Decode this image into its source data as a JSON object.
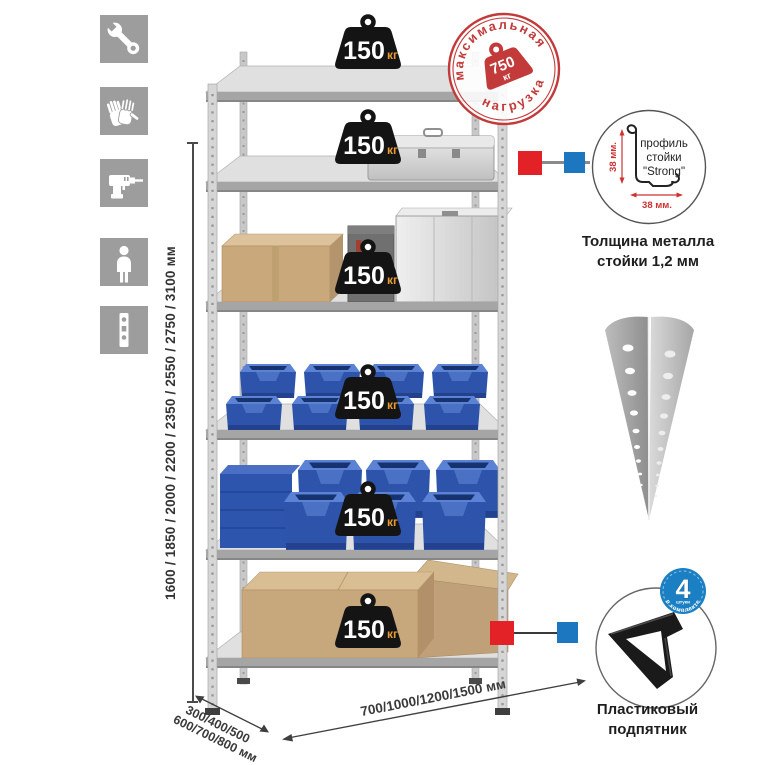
{
  "sidebar": {
    "icons": [
      {
        "name": "wrench-icon"
      },
      {
        "name": "gloves-icon"
      },
      {
        "name": "drill-icon"
      },
      {
        "name": "person-icon"
      },
      {
        "name": "post-icon"
      }
    ]
  },
  "height_dimension": {
    "label": "1600 / 1850 / 2000 / 2200 / 2350 / 2550 / 2750 / 3100 мм"
  },
  "depth_dimension": {
    "line1": "300/400/500",
    "line2": "600/700/800 мм"
  },
  "width_dimension": {
    "label": "700/1000/1200/1500 мм"
  },
  "shelves": [
    {
      "weight": "150",
      "unit": "кг"
    },
    {
      "weight": "150",
      "unit": "кг"
    },
    {
      "weight": "150",
      "unit": "кг"
    },
    {
      "weight": "150",
      "unit": "кг"
    },
    {
      "weight": "150",
      "unit": "кг"
    },
    {
      "weight": "150",
      "unit": "кг"
    }
  ],
  "max_load_stamp": {
    "arc_top": "максимальная",
    "arc_bottom": "нагрузка",
    "value": "750",
    "unit": "кг"
  },
  "profile_detail": {
    "line1": "профиль",
    "line2": "стойки",
    "line3": "\"Strong\"",
    "dim_v": "38 мм.",
    "dim_h": "38 мм.",
    "caption1": "Толщина металла",
    "caption2": "стойки 1,2 мм"
  },
  "foot_detail": {
    "badge_value": "4",
    "badge_sub": "штуки",
    "badge_arc": "в комплекте",
    "caption1": "Пластиковый",
    "caption2": "подпятник"
  },
  "colors": {
    "stamp_red": "#c23a3a",
    "marker_red": "#e32227",
    "marker_blue": "#1d76c0",
    "bin_blue": "#2d54aa",
    "badge_blue": "#1b7fc4",
    "weight_black": "#141414",
    "kg_orange": "#e89a33",
    "icon_gray": "#9d9d9d"
  }
}
